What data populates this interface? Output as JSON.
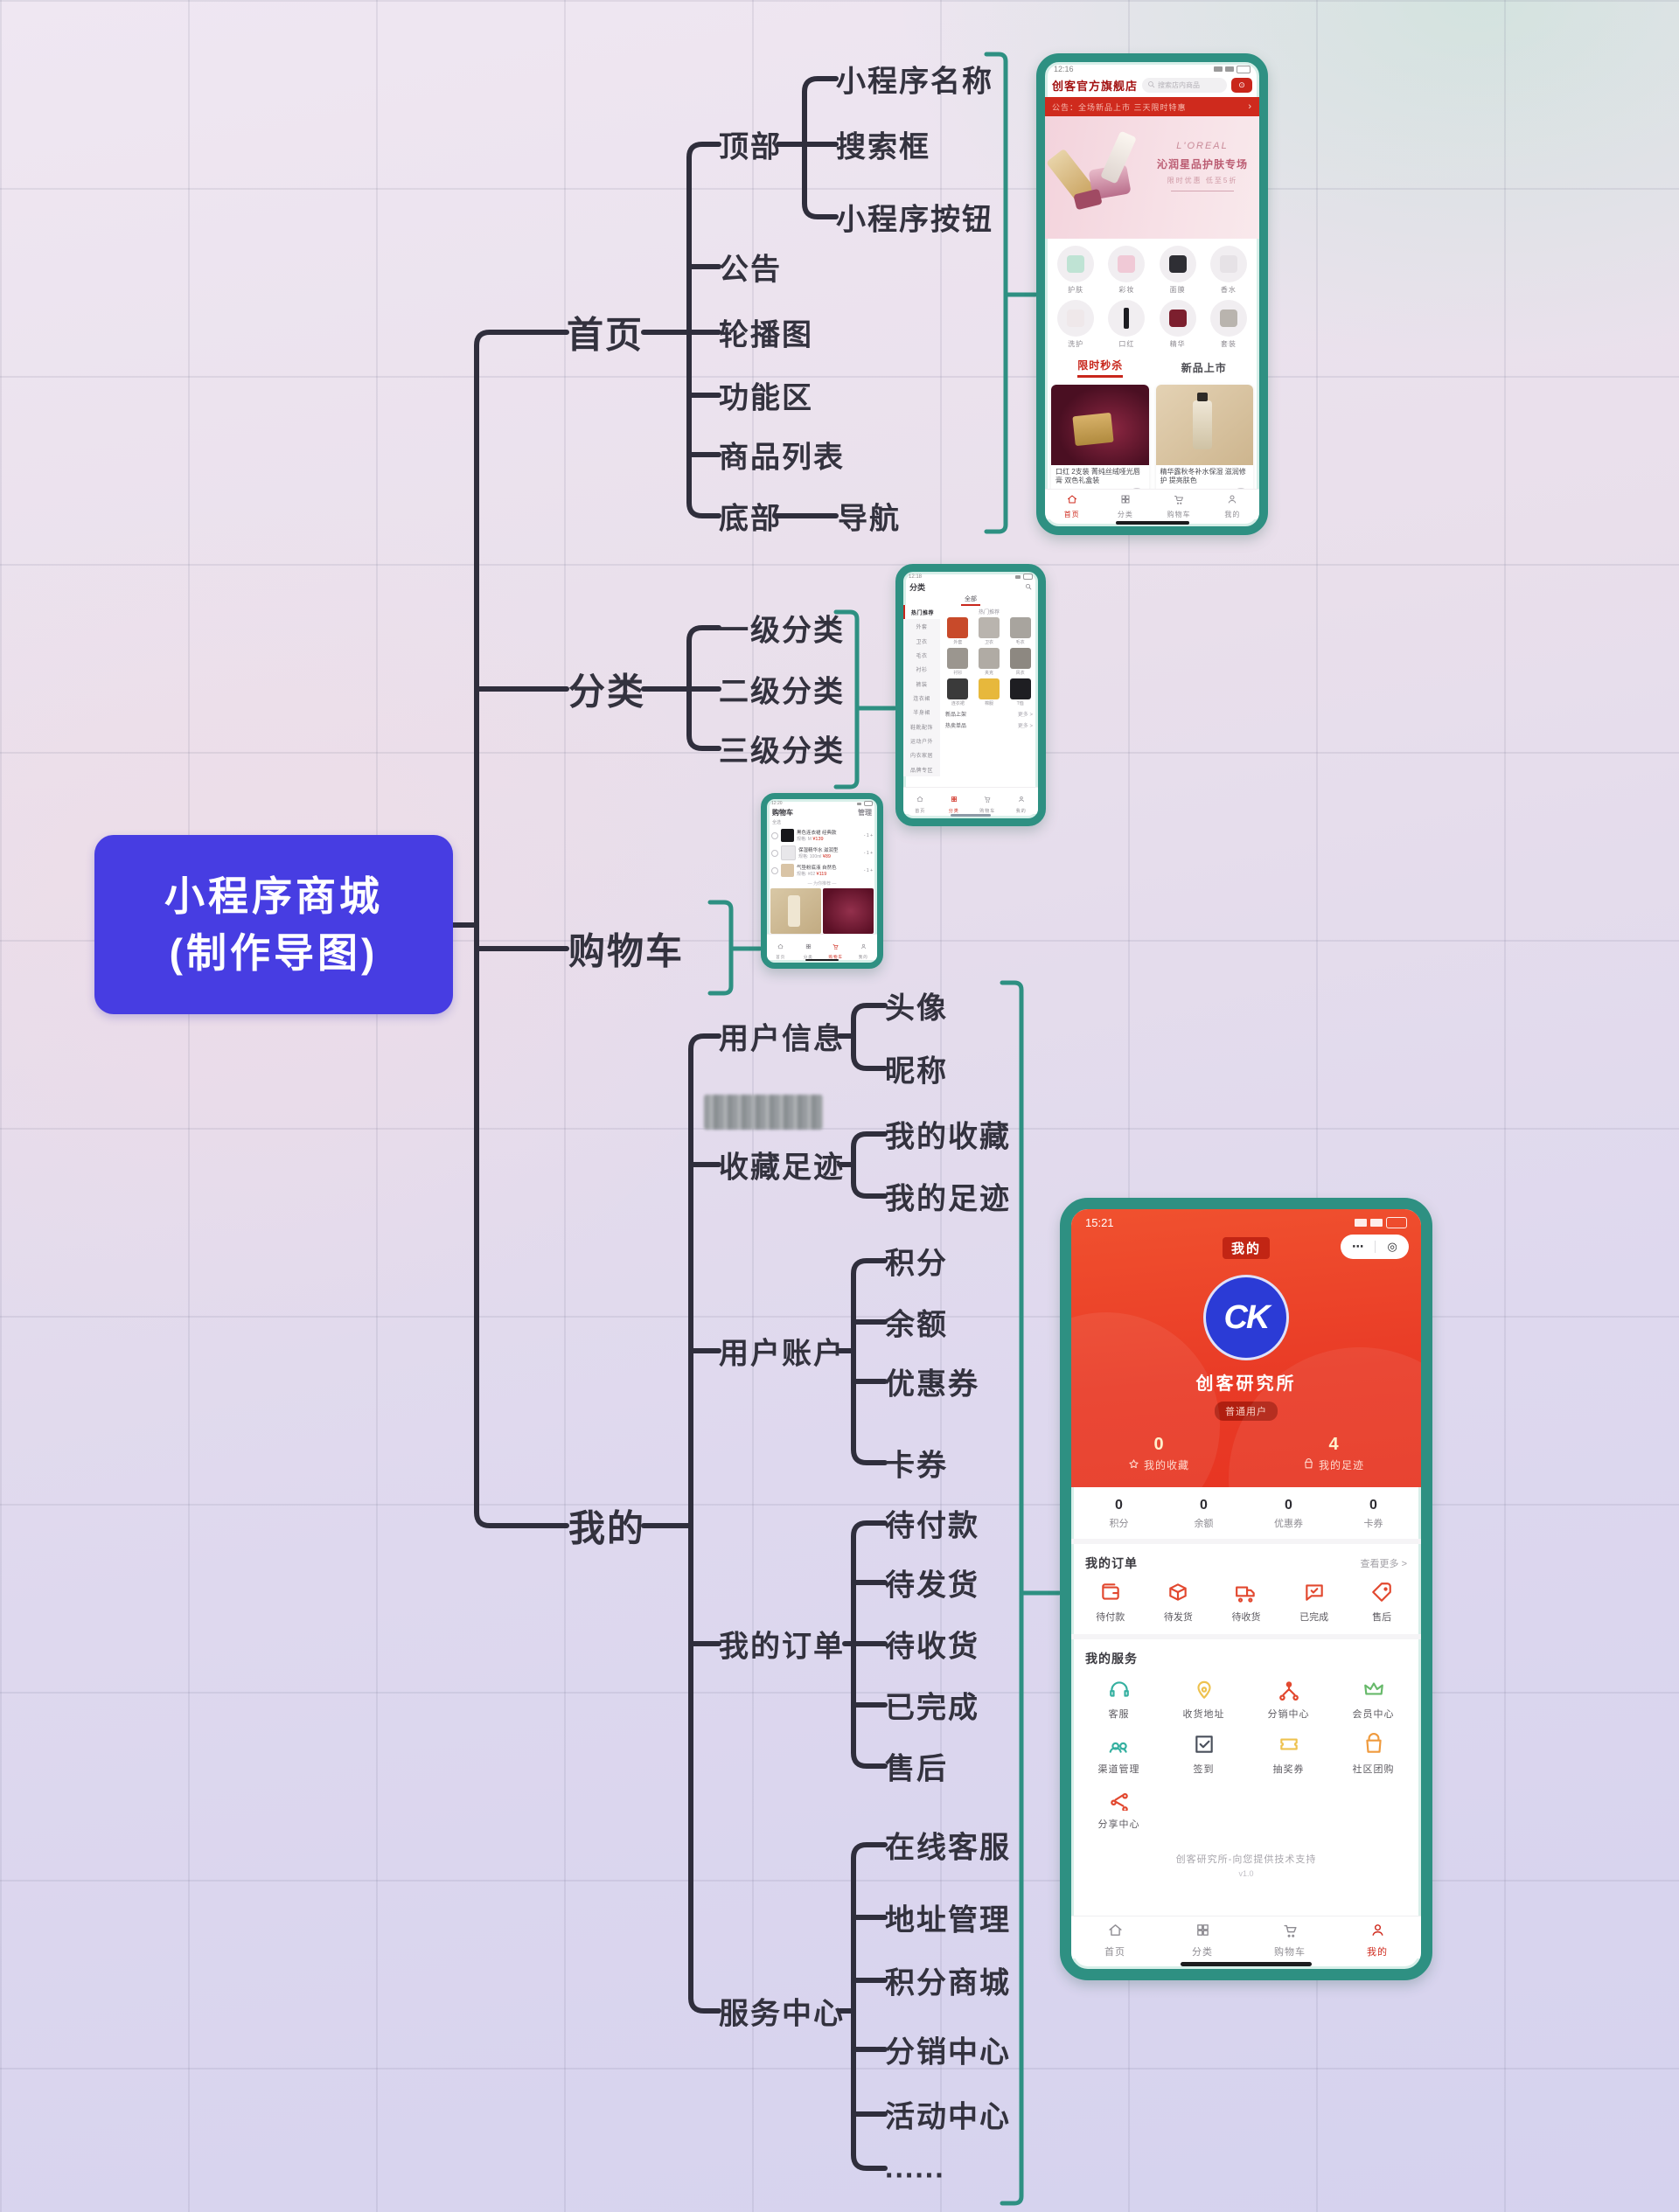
{
  "colors": {
    "accent_teal": "#2e9082",
    "line_dark": "#2f2e3c",
    "root_bg": "#473de2",
    "brand_red": "#cf2a1d",
    "profile_header_red": "#e93b26",
    "logo_blue": "#2b3bd6"
  },
  "mindmap": {
    "root": {
      "line1": "小程序商城",
      "line2": "(制作导图)"
    },
    "nodes": {
      "shouye": "首页",
      "dingbu": "顶部",
      "xcx_name": "小程序名称",
      "sousuokuang": "搜索框",
      "xcx_btn": "小程序按钮",
      "gonggao": "公告",
      "lunbotu": "轮播图",
      "gongnengqu": "功能区",
      "shangpinliebiao": "商品列表",
      "dibu": "底部",
      "daohang": "导航",
      "fenlei": "分类",
      "yiji": "一级分类",
      "erji": "二级分类",
      "sanji": "三级分类",
      "gouwuche": "购物车",
      "wode": "我的",
      "yonghuxinxi": "用户信息",
      "touxiang": "头像",
      "nicheng": "昵称",
      "shoucangzuji": "收藏足迹",
      "wodeshoucang": "我的收藏",
      "wodezuji": "我的足迹",
      "yonghuzhanghu": "用户账户",
      "jifen": "积分",
      "yue": "余额",
      "youhuiquan": "优惠券",
      "kaquan": "卡券",
      "wodedingdan": "我的订单",
      "daifukuan": "待付款",
      "daifahuo": "待发货",
      "daishouhuo": "待收货",
      "yiwancheng": "已完成",
      "shouhou": "售后",
      "fuwuzhongxin": "服务中心",
      "zaixiankefu": "在线客服",
      "dizhiguanli": "地址管理",
      "jifenshangcheng": "积分商城",
      "fenxiaozhongxin": "分销中心",
      "huodongzhongxin": "活动中心",
      "ellipsis": "......"
    }
  },
  "phones": {
    "home": {
      "status_time": "12:16",
      "store_name": "创客官方旗舰店",
      "search_placeholder": "搜索店内商品",
      "capsule_icon": "⊙",
      "announcement": "公告：全场新品上市 三天限时特惠",
      "announcement_arrow": "›",
      "banner": {
        "brand": "L'OREAL",
        "title": "沁润星品护肤专场",
        "subtitle": "限时优惠 低至5折"
      },
      "category_icons": [
        "护肤",
        "彩妆",
        "面膜",
        "香水",
        "洗护",
        "口红",
        "精华",
        "套装"
      ],
      "section_left": "限时秒杀",
      "section_right": "新品上市",
      "products": [
        {
          "title": "口红 2支装 菁纯丝绒哑光唇膏 双色礼盒装",
          "price": "¥188.00",
          "sold": "已售1000+"
        },
        {
          "title": "精华露秋冬补水保湿 滋润修护 提亮肤色",
          "price": "¥352.00",
          "sold": "已售99+"
        }
      ],
      "nav": [
        "首页",
        "分类",
        "购物车",
        "我的"
      ]
    },
    "category": {
      "status_time": "12:18",
      "header_title": "分类",
      "tab": "全部",
      "sidebar": [
        "热门推荐",
        "外套",
        "卫衣",
        "毛衣",
        "衬衫",
        "裤装",
        "连衣裙",
        "半身裙",
        "鞋靴配饰",
        "运动户外",
        "内衣家居",
        "品牌专区"
      ],
      "section_title": "热门推荐",
      "grid": [
        "外套",
        "卫衣",
        "毛衣",
        "衬衫",
        "夹克",
        "风衣",
        "连衣裙",
        "棉服",
        "T恤"
      ],
      "rows": [
        {
          "label": "新品上架",
          "more": "更多 >"
        },
        {
          "label": "热卖单品",
          "more": "更多 >"
        }
      ],
      "nav": [
        "首页",
        "分类",
        "购物车",
        "我的"
      ]
    },
    "cart": {
      "status_time": "12:20",
      "title": "购物车",
      "manage": "管理",
      "select_all": "全选",
      "items": [
        {
          "name": "黑色连衣裙 经典款",
          "spec": "规格: M",
          "price": "¥139",
          "qty": "- 1 +"
        },
        {
          "name": "保湿精华水 滋润型",
          "spec": "规格: 100ml",
          "price": "¥89",
          "qty": "- 1 +"
        },
        {
          "name": "气垫粉底液 自然色",
          "spec": "规格: #02",
          "price": "¥119",
          "qty": "- 1 +"
        }
      ],
      "recommend_title": "— 为你推荐 —",
      "total_label": "合计: ¥0.00",
      "checkout_label": "去结算",
      "nav": [
        "首页",
        "分类",
        "购物车",
        "我的"
      ]
    },
    "profile": {
      "status_time": "15:21",
      "title": "我的",
      "capsule_more": "⋯",
      "capsule_target": "◎",
      "logo_text": "CK",
      "username": "创客研究所",
      "badge": "普通用户",
      "stats": [
        {
          "value": "0",
          "label": "我的收藏",
          "icon": "star"
        },
        {
          "value": "4",
          "label": "我的足迹",
          "icon": "bag"
        }
      ],
      "account": [
        {
          "value": "0",
          "label": "积分"
        },
        {
          "value": "0",
          "label": "余额"
        },
        {
          "value": "0",
          "label": "优惠券"
        },
        {
          "value": "0",
          "label": "卡券"
        }
      ],
      "orders": {
        "title": "我的订单",
        "more": "查看更多 >",
        "items": [
          {
            "label": "待付款",
            "icon": "wallet"
          },
          {
            "label": "待发货",
            "icon": "box"
          },
          {
            "label": "待收货",
            "icon": "truck"
          },
          {
            "label": "已完成",
            "icon": "chatcheck"
          },
          {
            "label": "售后",
            "icon": "tag"
          }
        ]
      },
      "services": {
        "title": "我的服务",
        "items": [
          {
            "label": "客服",
            "icon": "headset",
            "color": "#35b0a0"
          },
          {
            "label": "收货地址",
            "icon": "pin",
            "color": "#eec24f"
          },
          {
            "label": "分销中心",
            "icon": "network",
            "color": "#e2482f"
          },
          {
            "label": "会员中心",
            "icon": "crown",
            "color": "#67b96a"
          },
          {
            "label": "渠道管理",
            "icon": "group",
            "color": "#35b0a0"
          },
          {
            "label": "签到",
            "icon": "checksq",
            "color": "#4a505c"
          },
          {
            "label": "抽奖券",
            "icon": "ticket",
            "color": "#eec24f"
          },
          {
            "label": "社区团购",
            "icon": "bag",
            "color": "#ef9a3d"
          },
          {
            "label": "分享中心",
            "icon": "share",
            "color": "#e2482f"
          }
        ]
      },
      "footer_line1": "创客研究所-向您提供技术支持",
      "footer_line2": "v1.0",
      "nav": [
        "首页",
        "分类",
        "购物车",
        "我的"
      ],
      "nav_active_index": 3
    }
  }
}
